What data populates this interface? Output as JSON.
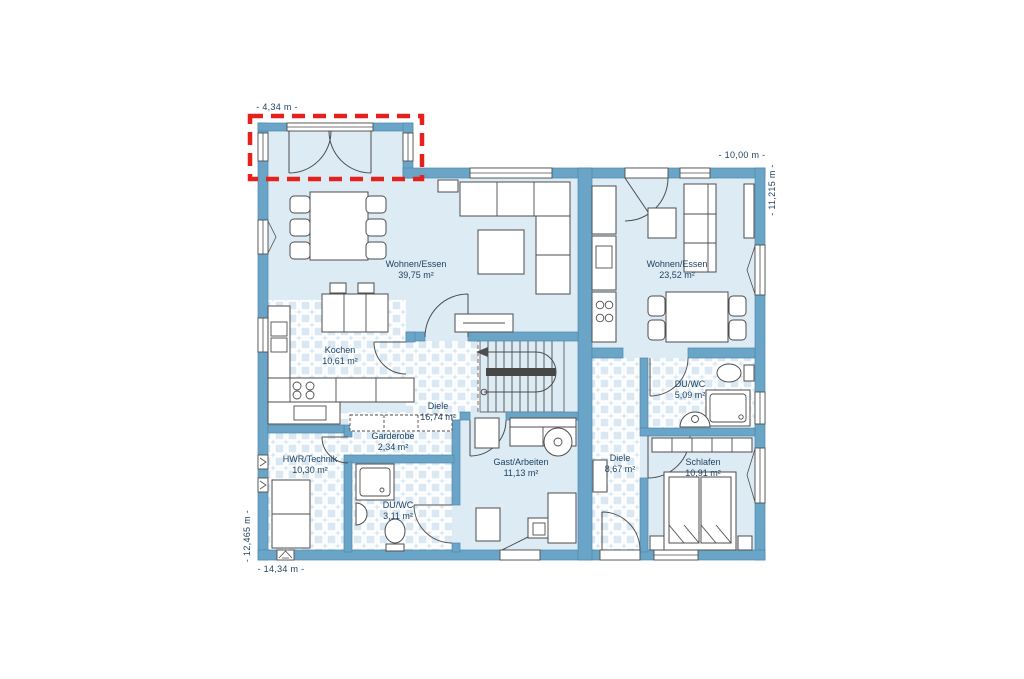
{
  "diagram_type": "floor-plan",
  "dimension_labels": {
    "annex_width_top": "- 4,34 m -",
    "right_wing_width_top": "- 10,00 m -",
    "right_side_height": "- 11,215 m -",
    "left_side_height": "- 12,465 m -",
    "total_width_bottom": "- 14,34 m -"
  },
  "units": {
    "left": {
      "wohnen": {
        "name": "Wohnen/Essen",
        "area": "39,75 m²"
      },
      "kochen": {
        "name": "Kochen",
        "area": "10,61 m²"
      },
      "diele": {
        "name": "Diele",
        "area": "16,74 m²"
      },
      "garderobe": {
        "name": "Garderobe",
        "area": "2,34 m²"
      },
      "hwr": {
        "name": "HWR/Technik",
        "area": "10,30 m²"
      },
      "duwc": {
        "name": "DU/WC",
        "area": "3,11 m²"
      },
      "gast": {
        "name": "Gast/Arbeiten",
        "area": "11,13 m²"
      }
    },
    "right": {
      "wohnen": {
        "name": "Wohnen/Essen",
        "area": "23,52 m²"
      },
      "duwc": {
        "name": "DU/WC",
        "area": "5,09 m²"
      },
      "diele": {
        "name": "Diele",
        "area": "8,67 m²"
      },
      "schlafen": {
        "name": "Schlafen",
        "area": "10,91 m²"
      }
    }
  },
  "colors": {
    "wall": "#6aa5c8",
    "floor": "#dcebf4",
    "tile": "#d9e8f2",
    "tile_grout": "#ffffff",
    "furniture_outline": "#4e4e4e",
    "label_text": "#1c3f5e",
    "highlight_dashed": "#e5211e",
    "stair_rail": "#474747",
    "background": "#ffffff"
  }
}
